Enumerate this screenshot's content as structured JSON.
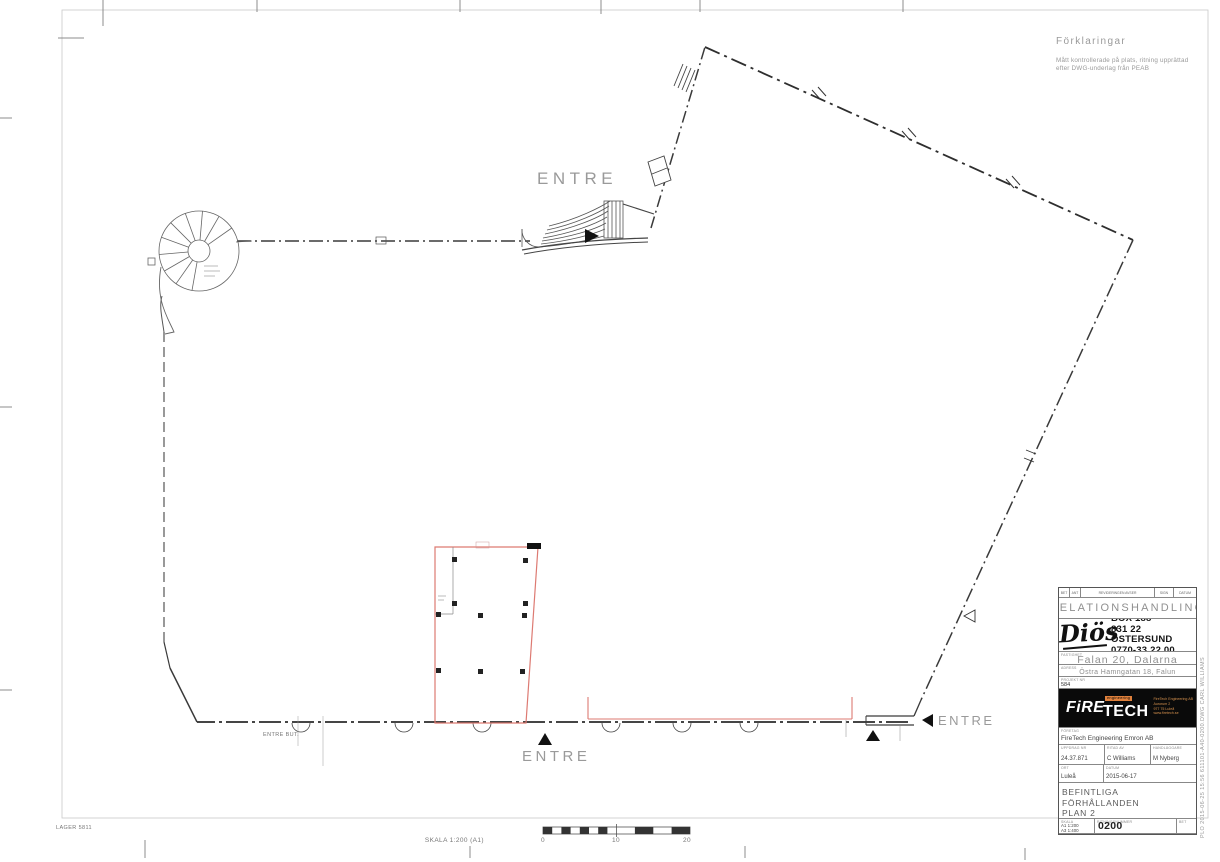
{
  "colors": {
    "wall": "#3a3a3a",
    "light_text": "#9a9a9a",
    "red_overlay": "#dd7a72",
    "brand_orange": "#e0813c"
  },
  "legend": {
    "title": "Förklaringar",
    "body_line1": "Mått kontrollerade på plats, ritning upprättad",
    "body_line2": "efter DWG-underlag från PEAB"
  },
  "plan_labels": {
    "entre_top": "ENTRE",
    "entre_bottom": "ENTRE",
    "entre_right": "ENTRE",
    "entre_butik": "ENTRE BUT.",
    "lager": "LAGER 5811"
  },
  "scalebar": {
    "label": "SKALA  1:200 (A1)",
    "tick0": "0",
    "tick10": "10",
    "tick20": "20"
  },
  "titleblock": {
    "revision_header": {
      "bet": "BET",
      "ant": "ANT",
      "avser": "REVIDERINGEN AVSER",
      "sign": "SIGN",
      "datum": "DATUM"
    },
    "document_status": "RELATIONSHANDLING",
    "client": {
      "logo_text": "Diös",
      "address_line1": "BOX 188",
      "address_line2": "831 22 ÖSTERSUND",
      "address_line3": "0770-33 22 00"
    },
    "property": {
      "label": "FASTIGHET",
      "value": "Falan 20, Dalarna"
    },
    "address": {
      "label": "ADRESS",
      "value": "Östra Hamngatan 18, Falun"
    },
    "project": {
      "label": "PROJEKT NR",
      "value": "584"
    },
    "consultant_logo": {
      "fire": "FiRE",
      "tech": "TECH",
      "engineering": "engineering",
      "addr1": "FireTech Engineering AB",
      "addr2": "Aurorum 2",
      "addr3": "977 75 Luleå",
      "addr4": "www.firetech.se"
    },
    "company": {
      "label": "FÖRETAG",
      "value": "FireTech Engineering Emron AB"
    },
    "assignment": {
      "label": "UPPDRAG NR",
      "value": "24.37.871"
    },
    "drawn_by": {
      "label": "RITAD AV",
      "value": "C Williams"
    },
    "handler": {
      "label": "HANDLÄGGARE",
      "value": "M Nyberg"
    },
    "place": {
      "label": "ORT",
      "value": "Luleå"
    },
    "date": {
      "label": "DATUM",
      "value": "2015-06-17"
    },
    "content_line1": "BEFINTLIGA FÖRHÅLLANDEN",
    "content_line2": "PLAN 2",
    "content_line3": "ÖVERSIKT",
    "scale": {
      "label": "SKALA",
      "a1": "A1 1:200",
      "a3": "A3 1:400"
    },
    "drawing_number": {
      "label": "RITNINGSNUMMER",
      "value": "611101-A40-0200"
    },
    "bet_label": "BET"
  },
  "plot_stamp": "PLO  2015-06-25  15:56   611101-A40-0200.DWG   CARL WILLIAMS"
}
